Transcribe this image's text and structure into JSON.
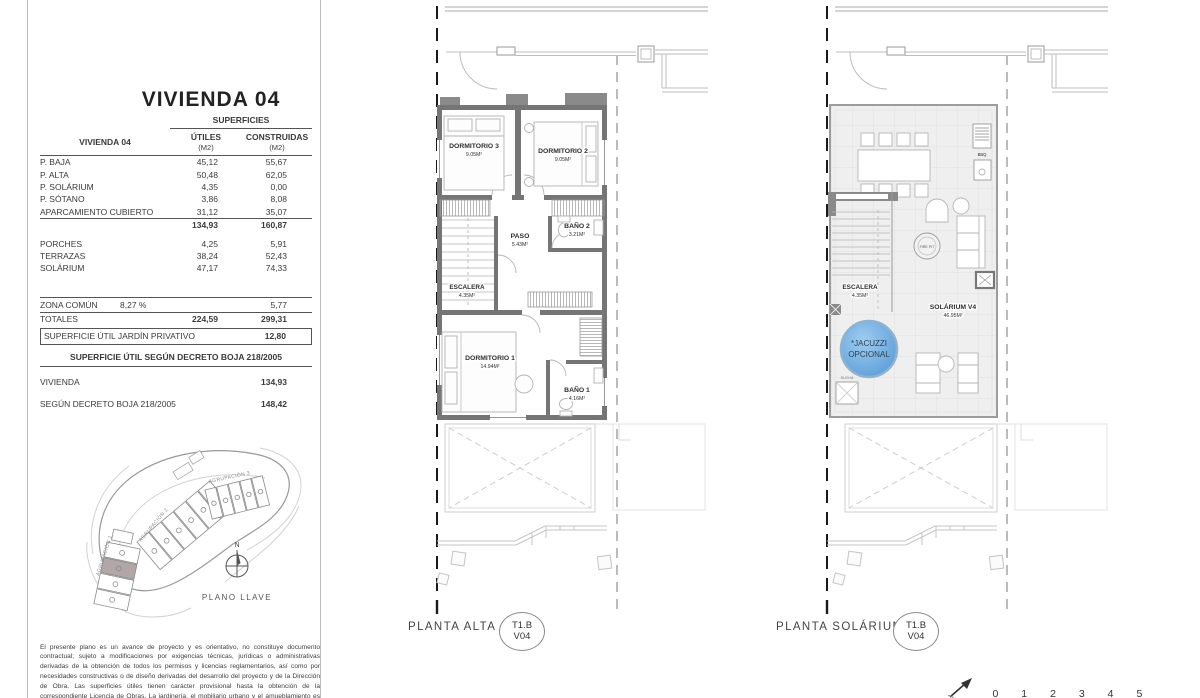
{
  "left_panel": {
    "title": "VIVIENDA 04",
    "table": {
      "header_group": "SUPERFICIES",
      "row_header": "VIVIENDA 04",
      "col_utiles": "ÚTILES",
      "col_utiles_sub": "(M2)",
      "col_construidas": "CONSTRUIDAS",
      "col_construidas_sub": "(M2)",
      "rows": [
        {
          "label": "P. BAJA",
          "utiles": "45,12",
          "construidas": "55,67"
        },
        {
          "label": "P. ALTA",
          "utiles": "50,48",
          "construidas": "62,05"
        },
        {
          "label": "P. SOLÁRIUM",
          "utiles": "4,35",
          "construidas": "0,00"
        },
        {
          "label": "P. SÓTANO",
          "utiles": "3,86",
          "construidas": "8,08"
        },
        {
          "label": "APARCAMIENTO CUBIERTO",
          "utiles": "31,12",
          "construidas": "35,07"
        }
      ],
      "subtotal": {
        "utiles": "134,93",
        "construidas": "160,87"
      },
      "rows_outdoor": [
        {
          "label": "PORCHES",
          "utiles": "4,25",
          "construidas": "5,91"
        },
        {
          "label": "TERRAZAS",
          "utiles": "38,24",
          "construidas": "52,43"
        },
        {
          "label": "SOLÁRIUM",
          "utiles": "47,17",
          "construidas": "74,33"
        }
      ],
      "zona_comun": {
        "label": "ZONA COMÚN",
        "percent": "8,27 %",
        "construidas": "5,77"
      },
      "totales": {
        "label": "TOTALES",
        "utiles": "224,59",
        "construidas": "299,31"
      },
      "jardin": {
        "label": "SUPERFICIE ÚTIL JARDÍN PRIVATIVO",
        "value": "12,80"
      },
      "decreto": {
        "header": "SUPERFICIE ÚTIL SEGÚN DECRETO BOJA 218/2005",
        "rows": [
          {
            "label": "VIVIENDA",
            "value": "134,93"
          },
          {
            "label": "SEGÚN DECRETO BOJA 218/2005",
            "value": "148,42"
          }
        ]
      }
    },
    "site_plan": {
      "group_labels": [
        "AGRUPACIÓN 1",
        "AGRUPACIÓN 2",
        "AGRUPACIÓN 3"
      ],
      "north": "N",
      "caption": "PLANO LLAVE"
    },
    "disclaimer": "El presente plano es un avance de proyecto y es orientativo, no constituye documento contractual; sujeto a modificaciones por exigencias técnicas, jurídicas o administrativas derivadas de la obtención de todos los permisos y licencias reglamentarios, así como por necesidades constructivas o de diseño derivadas del desarrollo del proyecto y de la Dirección de Obra. Las superficies útiles tienen carácter provisional hasta la obtención de la correspondiente Licencia de Obras. La jardinería, el mobiliario urbano y el amueblamiento es ficticio, teniendo validez únicamente a efectos decorativos."
  },
  "plans": {
    "alta": {
      "caption": "PLANTA ALTA",
      "badge_line1": "T1.B",
      "badge_line2": "V04",
      "rooms": [
        {
          "name": "DORMITORIO 3",
          "area": "9.05M²"
        },
        {
          "name": "DORMITORIO 2",
          "area": "9.05M²"
        },
        {
          "name": "PASO",
          "area": "5.43M²"
        },
        {
          "name": "BAÑO 2",
          "area": "3.21M²"
        },
        {
          "name": "ESCALERA",
          "area": "4.35M²"
        },
        {
          "name": "DORMITORIO 1",
          "area": "14.94M²"
        },
        {
          "name": "BAÑO 1",
          "area": "4.16M²"
        }
      ]
    },
    "solarium": {
      "caption": "PLANTA SOLÁRIUM",
      "badge_line1": "T1.B",
      "badge_line2": "V04",
      "rooms": [
        {
          "name": "ESCALERA",
          "area": "4.35M²"
        },
        {
          "name": "SOLÁRIUM V4",
          "area": "46.95M²"
        }
      ],
      "jacuzzi_line1": "*JACUZZI",
      "jacuzzi_line2": "OPCIONAL",
      "bbq_label": "BBQ",
      "firepit_label": "FIRE PIT",
      "ducha_label": "DUCHA"
    }
  },
  "scale_bar": {
    "numbers": [
      "0",
      "1",
      "2",
      "3",
      "4",
      "5"
    ]
  },
  "colors": {
    "wall_gray": "#757575",
    "wall_dark": "#8a8a8a",
    "jacuzzi_light": "#9ecdf0",
    "jacuzzi_deep": "#5b9bd8",
    "highlight_unit": "#b2a6a6",
    "rule_dark": "#555555"
  }
}
